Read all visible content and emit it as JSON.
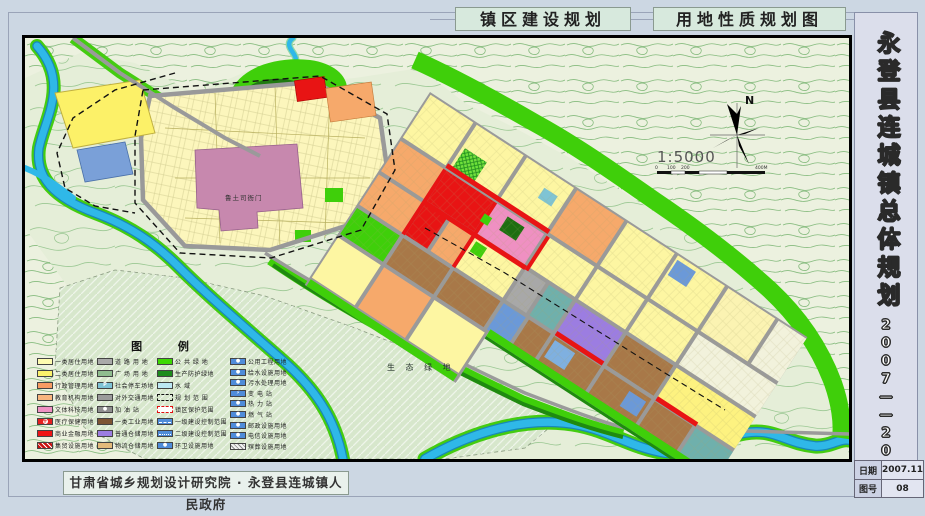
{
  "header": {
    "title1": "镇区建设规划",
    "title2": "用地性质规划图"
  },
  "sidebar": {
    "title": "永登县连城镇总体规划",
    "years": "2007——2020",
    "date_label": "日期",
    "date_value": "2007.11",
    "sheet_label": "图号",
    "sheet_value": "08"
  },
  "footer": {
    "credit": "甘肃省城乡规划设计研究院 · 永登县连城镇人民政府"
  },
  "map": {
    "labels": {
      "heritage": "鲁土司衙门",
      "eco_green": "生 态 绿 地",
      "north": "N",
      "scale": "1:5000",
      "scale_ticks": [
        "0",
        "100",
        "200",
        "400M"
      ]
    }
  },
  "legend": {
    "title": "图 例",
    "columns": [
      [
        {
          "label": "一类居住用地",
          "color": "#fdfbaf"
        },
        {
          "label": "二类居住用地",
          "color": "#fbf26b"
        },
        {
          "label": "行政管理用地",
          "color": "#f79b63"
        },
        {
          "label": "教育机构用地",
          "color": "#f8b57e"
        },
        {
          "label": "文体科技用地",
          "color": "#f091c3"
        },
        {
          "label": "医疗保健用地",
          "color": "#e62020",
          "type": "cross"
        },
        {
          "label": "商业金融用地",
          "color": "#ee1616"
        },
        {
          "label": "集贸设施用地",
          "color": "#c91111",
          "type": "stripes"
        }
      ],
      [
        {
          "label": "道 路 用 地",
          "color": "#a9a9a9"
        },
        {
          "label": "广 场 用 地",
          "color": "#8fbd8f"
        },
        {
          "label": "社会停车场地",
          "color": "#7fc3d6",
          "type": "glyph",
          "glyph": "P"
        },
        {
          "label": "对外交通用地",
          "color": "#9b9b9b"
        },
        {
          "label": "加 油 站",
          "color": "#8f8f8f",
          "type": "glyph",
          "glyph": "●"
        },
        {
          "label": "一类工业用地",
          "color": "#7d5433"
        },
        {
          "label": "普通仓储用地",
          "color": "#9c7de1"
        },
        {
          "label": "物流仓储用地",
          "color": "#e3ba7b"
        }
      ],
      [
        {
          "label": "公 共 绿 地",
          "color": "#3ed903"
        },
        {
          "label": "生产防护绿地",
          "color": "#1d8b1d"
        },
        {
          "label": "水    域",
          "color": "#bce7f3"
        },
        {
          "label": "规 划 范 围",
          "type": "dash-black"
        },
        {
          "label": "镇区保护范围",
          "type": "dash-red"
        },
        {
          "label": "一级建设控制范围",
          "color": "#4f8cd9",
          "type": "line-dash"
        },
        {
          "label": "二级建设控制范围",
          "color": "#4f8cd9",
          "type": "line-dashdot"
        },
        {
          "label": "环卫设施用地",
          "color": "#4f8cd9",
          "type": "glyph",
          "glyph": "●"
        }
      ],
      [
        {
          "label": "公用工程用地",
          "color": "#4f8cd9",
          "type": "glyph",
          "glyph": "●"
        },
        {
          "label": "给水设施用地",
          "color": "#4f8cd9",
          "type": "glyph",
          "glyph": "●"
        },
        {
          "label": "污水处理用地",
          "color": "#4f8cd9",
          "type": "glyph",
          "glyph": "●"
        },
        {
          "label": "变  电  站",
          "color": "#4f8cd9",
          "type": "glyph",
          "glyph": "⚡"
        },
        {
          "label": "热  力  站",
          "color": "#4f8cd9",
          "type": "glyph",
          "glyph": "●"
        },
        {
          "label": "燃  气  站",
          "color": "#4f8cd9",
          "type": "glyph",
          "glyph": "●"
        },
        {
          "label": "邮政设施用地",
          "color": "#4f8cd9",
          "type": "glyph",
          "glyph": "●"
        },
        {
          "label": "电信设施用地",
          "color": "#4f8cd9",
          "type": "glyph",
          "glyph": "●"
        },
        {
          "label": "殡葬设施用地",
          "type": "hatch-gray"
        }
      ]
    ]
  }
}
